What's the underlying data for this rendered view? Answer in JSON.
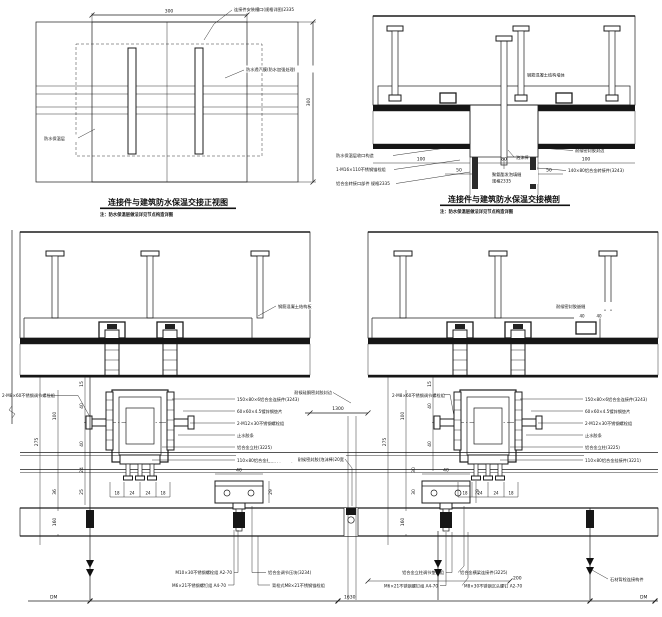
{
  "drawing": {
    "front_view": {
      "title": "连接件与建筑防水保温交接正视图",
      "note": "注：防水保温层做法详见节点构造详图",
      "dim_width": "300",
      "dim_height": "300",
      "label_slot": "连接件安装槽口(规格详图)2335",
      "label_membrane": "防水透汽膜(防水加强处理)",
      "label_insulation": "防水保温层"
    },
    "section_view": {
      "title": "连接件与建筑防水保温交接横剖",
      "note": "注：防水保温层做法详见节点构造详图",
      "label_wall": "钢筋混凝土结构墙体",
      "label_left_1": "防水保温层收口构造",
      "label_left_2": "1-M16×110不锈钢锚栓组",
      "label_left_3": "铝合金转接口部件 规格2335",
      "label_right_1": "耐候密封胶封边",
      "label_right_2": "140×80铝合金转接件(3243)",
      "label_foam": "泡沫棒",
      "label_fill_1": "聚氨酯发泡填缝",
      "label_fill_2": "规格2335",
      "dims": {
        "left_100": "100",
        "left_50": "50",
        "mid_80": "80",
        "right_50": "50",
        "right_100": "100"
      }
    },
    "callouts": {
      "c1": "150×80×6铝合金连接件(3243)",
      "c2": "60×60×4.5镀锌钢垫片",
      "c3": "2-M12×30不锈钢螺栓组",
      "c4": "止水胶条",
      "c5": "铝合金立柱(3225)",
      "c6": "110×80铝合金挂接件(3221)",
      "bolt": "2-M8×60不锈钢调节螺栓组",
      "slab": "钢筋混凝土结构板",
      "seal_edge": "耐候硅酮密封胶封边",
      "seal_joint": "耐候密封胶(泡沫棒)20宽",
      "seal_top": "耐候密封胶嵌缝"
    },
    "detail_left": {
      "dims": {
        "d275": "275",
        "d100": "100",
        "d36": "36",
        "d160": "160",
        "d15": "15",
        "d40a": "40",
        "d40b": "40",
        "d24": "24",
        "d25": "25",
        "b1": "18",
        "b2": "24",
        "b3": "24",
        "b4": "18",
        "s40": "40",
        "s29": "29",
        "datum": "DM"
      },
      "bottom": {
        "r1": "M10×30不锈钢螺栓组 A2-70",
        "r2": "M6×21不锈钢螺钉组 A4-70",
        "r3": "铝合金调节压块(3234)",
        "r4": "背栓式M8×21不锈钢锚栓组"
      }
    },
    "detail_right": {
      "dims": {
        "d275": "275",
        "d100": "100",
        "d160": "160",
        "d15": "15",
        "d40a": "40",
        "d40b": "40",
        "d30a": "30",
        "d30b": "30",
        "b1": "18",
        "b2": "24",
        "b3": "24",
        "b4": "18",
        "s40": "40",
        "s29": "29",
        "s40a": "40",
        "s40b": "40",
        "d200": "200",
        "datum": "DM"
      },
      "bottom": {
        "r1": "铝合金立柱调节垫片组",
        "r2": "M6×21不锈钢螺钉组 A4-70",
        "r3": "铝合金横梁连接件(3225)",
        "r4": "M8×30不锈钢沉头螺钉 A2-70",
        "r5": "石材背栓连接构件"
      }
    },
    "joint": {
      "span": "1300",
      "bottom_span": "1630"
    }
  }
}
